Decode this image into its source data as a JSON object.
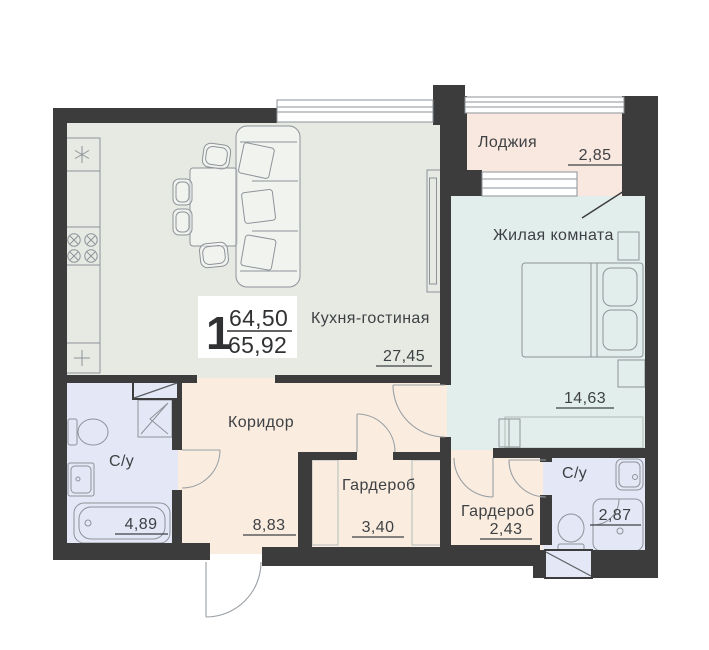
{
  "plan": {
    "type": "apartment-floor-plan",
    "unit": {
      "rooms_count": "1",
      "area_top": "64,50",
      "area_bottom": "65,92"
    },
    "rooms": [
      {
        "id": "loggia",
        "name": "Лоджия",
        "area": "2,85"
      },
      {
        "id": "living-room",
        "name": "Жилая комната",
        "area": "14,63"
      },
      {
        "id": "kitchen-living",
        "name": "Кухня-гостиная",
        "area": "27,45"
      },
      {
        "id": "corridor",
        "name": "Коридор",
        "area": "8,83"
      },
      {
        "id": "bathroom-1",
        "name": "С/у",
        "area": "4,89"
      },
      {
        "id": "wardrobe-1",
        "name": "Гардероб",
        "area": "3,40"
      },
      {
        "id": "wardrobe-2",
        "name": "Гардероб",
        "area": "2,43"
      },
      {
        "id": "bathroom-2",
        "name": "С/у",
        "area": "2,87"
      }
    ],
    "colors": {
      "wall": "#3c3c3c",
      "kitchen_living": "#e6eae2",
      "living_room": "#e2eeeb",
      "loggia": "#f9e8df",
      "corridor": "#faecdf",
      "bathroom": "#e4e7f6",
      "furniture_stroke": "#8e939a",
      "text": "#3e4144"
    }
  }
}
